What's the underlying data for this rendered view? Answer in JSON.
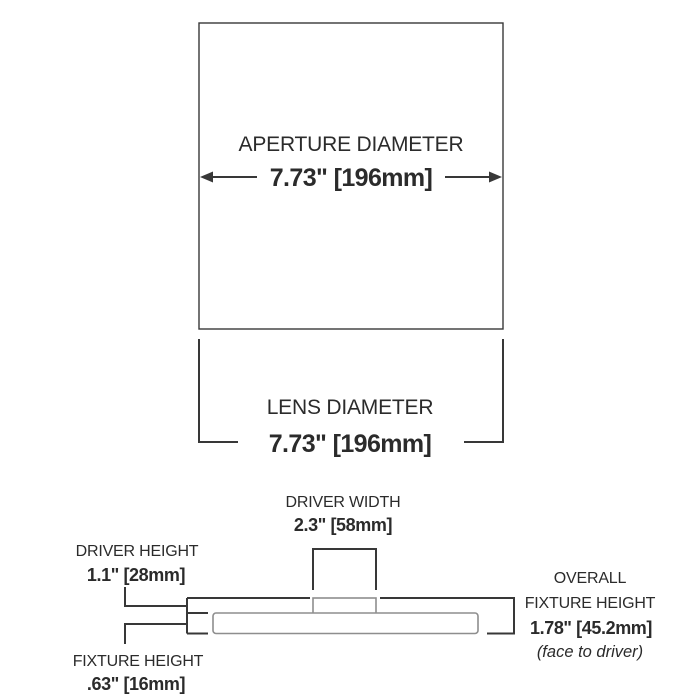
{
  "colors": {
    "background": "#ffffff",
    "line_dark": "#383838",
    "line_gray": "#8e8e8e",
    "text": "#2b2b2b"
  },
  "aperture": {
    "label": "APERTURE DIAMETER",
    "value": "7.73\" [196mm]"
  },
  "lens": {
    "label": "LENS DIAMETER",
    "value": "7.73\" [196mm]"
  },
  "driver_width": {
    "label": "DRIVER WIDTH",
    "value": "2.3\" [58mm]"
  },
  "driver_height": {
    "label": "DRIVER HEIGHT",
    "value": "1.1\" [28mm]"
  },
  "fixture_height": {
    "label": "FIXTURE HEIGHT",
    "value": ".63\" [16mm]"
  },
  "overall_fixture_height": {
    "label_line1": "OVERALL",
    "label_line2": "FIXTURE HEIGHT",
    "value": "1.78\" [45.2mm]",
    "note": "(face to driver)"
  }
}
